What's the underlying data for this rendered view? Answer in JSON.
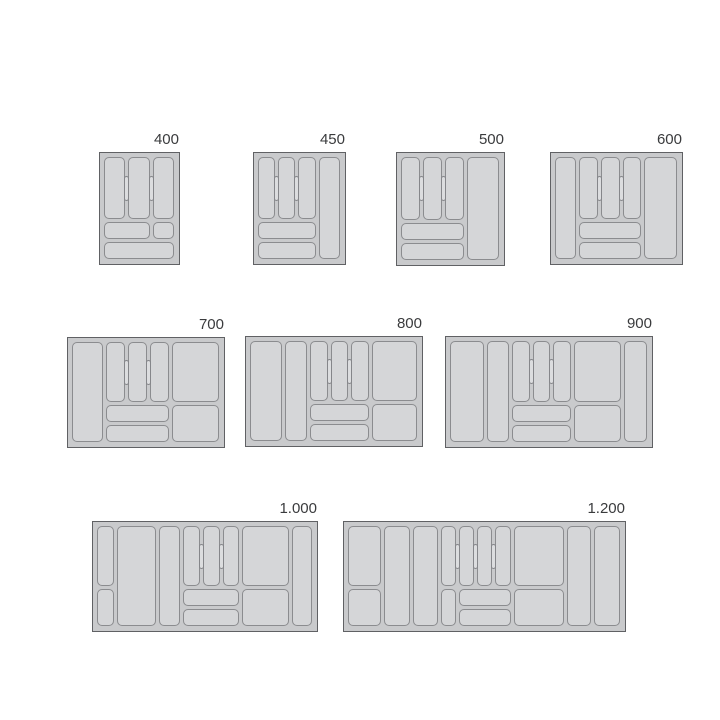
{
  "diagram": {
    "name": "cutlery-tray-size-chart",
    "background": "#ffffff",
    "colors": {
      "tray_fill": "#c9cacc",
      "tray_border": "#606164",
      "cell_fill": "#d5d6d8",
      "cell_border": "#8b8c8f",
      "pill_fill": "#dcdddf",
      "pill_border": "#85868a",
      "label_color": "#3a3b3d"
    },
    "trays": [
      {
        "label": "400",
        "x": 99,
        "y": 152,
        "w": 81,
        "h": 113,
        "cols": [
          1,
          1,
          1
        ],
        "cells": [
          [
            0,
            1,
            "T"
          ],
          [
            1,
            1,
            "T"
          ],
          [
            2,
            1,
            "T"
          ],
          [
            0,
            2,
            "M"
          ],
          [
            2,
            1,
            "M"
          ],
          [
            0,
            3,
            "B"
          ]
        ],
        "pills": [
          0,
          1
        ]
      },
      {
        "label": "450",
        "x": 253,
        "y": 152,
        "w": 93,
        "h": 113,
        "cols": [
          1,
          1,
          1,
          1.25
        ],
        "cells": [
          [
            0,
            1,
            "T"
          ],
          [
            1,
            1,
            "T"
          ],
          [
            2,
            1,
            "T"
          ],
          [
            3,
            1,
            "TMB"
          ],
          [
            0,
            3,
            "M"
          ],
          [
            0,
            3,
            "B"
          ]
        ],
        "pills": [
          0,
          1
        ]
      },
      {
        "label": "500",
        "x": 396,
        "y": 152,
        "w": 109,
        "h": 114,
        "cols": [
          1,
          1,
          1,
          1.7
        ],
        "cells": [
          [
            0,
            1,
            "T"
          ],
          [
            1,
            1,
            "T"
          ],
          [
            2,
            1,
            "T"
          ],
          [
            3,
            1,
            "TMB"
          ],
          [
            0,
            3,
            "M"
          ],
          [
            0,
            3,
            "B"
          ]
        ],
        "pills": [
          0,
          1
        ]
      },
      {
        "label": "600",
        "x": 550,
        "y": 152,
        "w": 133,
        "h": 113,
        "cols": [
          1.15,
          1,
          1,
          1,
          1.75
        ],
        "cells": [
          [
            0,
            1,
            "TMB"
          ],
          [
            1,
            1,
            "T"
          ],
          [
            2,
            1,
            "T"
          ],
          [
            3,
            1,
            "T"
          ],
          [
            4,
            1,
            "TMB"
          ],
          [
            1,
            3,
            "M"
          ],
          [
            1,
            3,
            "B"
          ]
        ],
        "pills": [
          1,
          2
        ]
      },
      {
        "label": "700",
        "x": 67,
        "y": 337,
        "w": 158,
        "h": 111,
        "cols": [
          1.65,
          1,
          1,
          1,
          2.45
        ],
        "cells": [
          [
            0,
            1,
            "TMB"
          ],
          [
            1,
            1,
            "T"
          ],
          [
            2,
            1,
            "T"
          ],
          [
            3,
            1,
            "T"
          ],
          [
            4,
            1,
            "T"
          ],
          [
            1,
            3,
            "M"
          ],
          [
            1,
            3,
            "B"
          ],
          [
            4,
            1,
            "MB"
          ]
        ],
        "pills": [
          1,
          2
        ]
      },
      {
        "label": "800",
        "x": 245,
        "y": 336,
        "w": 178,
        "h": 111,
        "cols": [
          1.8,
          1.25,
          1,
          1,
          1,
          2.55
        ],
        "cells": [
          [
            0,
            1,
            "TMB"
          ],
          [
            1,
            1,
            "TMB"
          ],
          [
            2,
            1,
            "T"
          ],
          [
            3,
            1,
            "T"
          ],
          [
            4,
            1,
            "T"
          ],
          [
            5,
            1,
            "T"
          ],
          [
            2,
            3,
            "M"
          ],
          [
            2,
            3,
            "B"
          ],
          [
            5,
            1,
            "MB"
          ]
        ],
        "pills": [
          2,
          3
        ]
      },
      {
        "label": "900",
        "x": 445,
        "y": 336,
        "w": 208,
        "h": 112,
        "cols": [
          1.9,
          1.25,
          1,
          1,
          1,
          2.65,
          1.3
        ],
        "cells": [
          [
            0,
            1,
            "TMB"
          ],
          [
            1,
            1,
            "TMB"
          ],
          [
            2,
            1,
            "T"
          ],
          [
            3,
            1,
            "T"
          ],
          [
            4,
            1,
            "T"
          ],
          [
            5,
            1,
            "T"
          ],
          [
            6,
            1,
            "TMB"
          ],
          [
            2,
            3,
            "M"
          ],
          [
            2,
            3,
            "B"
          ],
          [
            5,
            1,
            "MB"
          ]
        ],
        "pills": [
          2,
          3
        ]
      },
      {
        "label": "1.000",
        "x": 92,
        "y": 521,
        "w": 226,
        "h": 111,
        "cols": [
          1.05,
          2.3,
          1.3,
          1,
          1,
          1,
          2.8,
          1.2
        ],
        "cells": [
          [
            0,
            1,
            "T"
          ],
          [
            0,
            1,
            "MB"
          ],
          [
            1,
            1,
            "TMB"
          ],
          [
            2,
            1,
            "TMB"
          ],
          [
            3,
            1,
            "T"
          ],
          [
            4,
            1,
            "T"
          ],
          [
            5,
            1,
            "T"
          ],
          [
            6,
            1,
            "T"
          ],
          [
            7,
            1,
            "TMB"
          ],
          [
            3,
            3,
            "M"
          ],
          [
            3,
            3,
            "B"
          ],
          [
            6,
            1,
            "MB"
          ]
        ],
        "pills": [
          3,
          4
        ]
      },
      {
        "label": "1.200",
        "x": 343,
        "y": 521,
        "w": 283,
        "h": 111,
        "cols": [
          2.2,
          1.7,
          1.6,
          1,
          1,
          1,
          1,
          3.3,
          1.6,
          1.7
        ],
        "cells": [
          [
            0,
            1,
            "T"
          ],
          [
            0,
            1,
            "MB"
          ],
          [
            1,
            1,
            "TMB"
          ],
          [
            2,
            1,
            "TMB"
          ],
          [
            3,
            1,
            "T"
          ],
          [
            4,
            1,
            "T"
          ],
          [
            5,
            1,
            "T"
          ],
          [
            6,
            1,
            "T"
          ],
          [
            3,
            1,
            "MB"
          ],
          [
            4,
            3,
            "M"
          ],
          [
            4,
            3,
            "B"
          ],
          [
            7,
            1,
            "T"
          ],
          [
            7,
            1,
            "MB"
          ],
          [
            8,
            1,
            "TMB"
          ],
          [
            9,
            1,
            "TMB"
          ]
        ],
        "pills": [
          3,
          4,
          5
        ]
      }
    ]
  }
}
